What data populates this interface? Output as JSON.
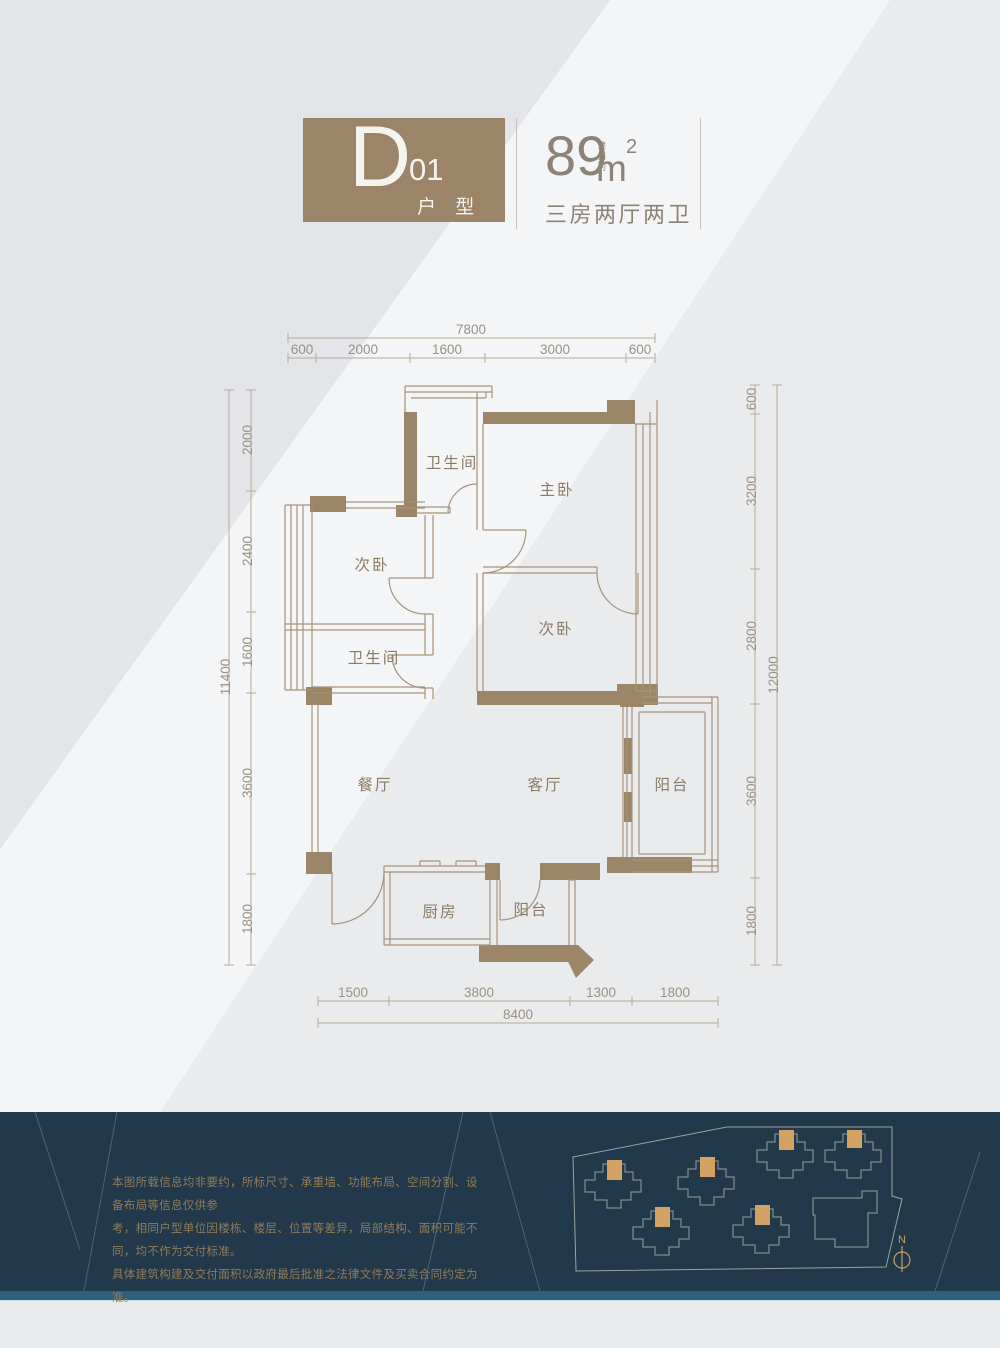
{
  "header": {
    "type_letter": "D",
    "type_number": "01",
    "type_suffix": "户 型",
    "area_prefix": "建面约",
    "area_value": "89",
    "area_unit": "m",
    "area_exponent": "2",
    "layout_label": "三房两厅两卫"
  },
  "plan": {
    "rooms": {
      "bath_top": "卫生间",
      "master": "主卧",
      "bed_left": "次卧",
      "bed_right": "次卧",
      "bath_left": "卫生间",
      "dining": "餐厅",
      "living": "客厅",
      "balcony_right": "阳台",
      "kitchen": "厨房",
      "balcony_bottom": "阳台"
    },
    "dims": {
      "top_total": "7800",
      "top_segs": [
        "600",
        "2000",
        "1600",
        "3000",
        "600"
      ],
      "left_total": "11400",
      "left_segs": [
        "2000",
        "2400",
        "1600",
        "3600",
        "1800"
      ],
      "right_total": "12000",
      "right_segs": [
        "600",
        "3200",
        "2800",
        "3600",
        "1800"
      ],
      "bottom_total": "8400",
      "bottom_segs": [
        "1500",
        "3800",
        "1300",
        "1800"
      ]
    }
  },
  "footer": {
    "disclaimer": [
      "本图所载信息均非要约，所标尺寸、承重墙、功能布局、空间分割、设备布局等信息仅供参",
      "考，相同户型单位因楼栋、楼层、位置等差异，局部结构、面积可能不同，均不作为交付标准。",
      "具体建筑构建及交付面积以政府最后批准之法律文件及买卖合同约定为准。"
    ],
    "north": "N"
  },
  "colors": {
    "accent_brown": "#9b8468",
    "wall_line": "#a8937a",
    "dim_line": "#b7ac97",
    "footer_dark": "#21394a",
    "footer_strip": "#2d607a",
    "site_building": "#d3a263"
  }
}
